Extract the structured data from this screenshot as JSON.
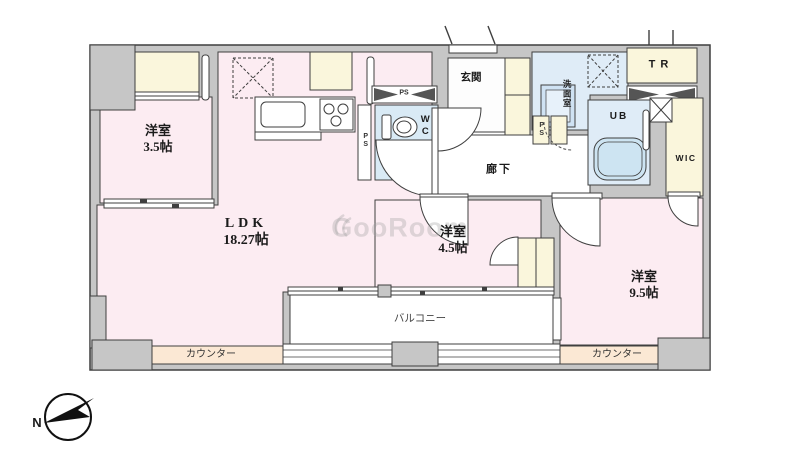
{
  "plan": {
    "rooms": {
      "west_room_small": {
        "name": "洋室",
        "size": "3.5帖"
      },
      "ldk": {
        "name": "LDK",
        "size": "18.27帖"
      },
      "west_room_mid": {
        "name": "洋室",
        "size": "4.5帖"
      },
      "west_room_large": {
        "name": "洋室",
        "size": "9.5帖"
      }
    },
    "areas": {
      "entrance": "玄関",
      "hallway": "廊下",
      "washroom": "洗面室",
      "toilet": "WC",
      "unit_bath": "UB",
      "trunk_room": "TR",
      "walk_in_closet": "WIC",
      "balcony": "バルコニー",
      "counter_left": "カウンター",
      "counter_right": "カウンター"
    },
    "pipe_spaces": {
      "ps_above_wc": "PS",
      "ps_beside_wc": "PS",
      "ps_by_washroom": "PS"
    },
    "compass": {
      "north_label": "N"
    },
    "watermark": {
      "text": "GooRoom"
    },
    "colors": {
      "room_pink": "#fcecf2",
      "closet_cream": "#faf6dc",
      "wet_blue": "#dfecf7",
      "counter_peach": "#fbe8d4",
      "wall_gray": "#c6c6c6",
      "outline": "#3f3f3f"
    }
  }
}
